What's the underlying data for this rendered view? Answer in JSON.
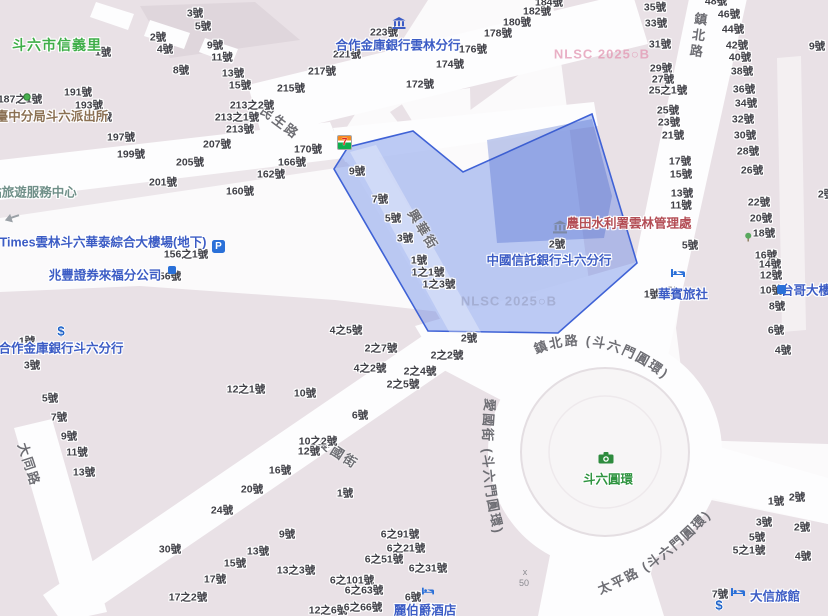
{
  "district_label": "斗六市信義里",
  "street_names": {
    "minsheng": "民生路",
    "xinghua": "興華街",
    "zhenbei": "鎮北路",
    "datong": "大同路",
    "aiguo": "愛國街",
    "zhenbei_circle": "鎮北路 (斗六門圓環)",
    "aiguo_circle": "愛國街 (斗六門圓環)",
    "taiping_circle": "太平路 (斗六門圓環)"
  },
  "colors": {
    "poi_blue": "#3c5cc5",
    "poi_green": "#2f9440",
    "poi_red": "#b34d55",
    "poi_brown": "#8a6f52",
    "poi_teal": "#6f8f88",
    "highlight_fill": "rgba(90,125,230,0.40)",
    "highlight_stroke": "#3f62d6",
    "block": "#e9e1e6",
    "street": "#fdfdfe"
  },
  "pois": [
    {
      "id": "hezuo-yunlin-branch",
      "label": "合作金庫銀行雲林分行",
      "x": 398,
      "y": 44,
      "color": "blue"
    },
    {
      "id": "police-station",
      "label": "臺中分局斗六派出所",
      "x": 52,
      "y": 115,
      "color": "brown"
    },
    {
      "id": "tourist-service-center",
      "label": "站旅遊服務中心",
      "x": 33,
      "y": 191,
      "color": "teal"
    },
    {
      "id": "times-parking",
      "label": "Times雲林斗六華泰綜合大樓場(地下)",
      "x": 103,
      "y": 241,
      "color": "blue"
    },
    {
      "id": "mega-securities",
      "label": "兆豐證券來福分公司",
      "x": 105,
      "y": 274,
      "color": "blue"
    },
    {
      "id": "hezuo-douliu-branch",
      "label": "合作金庫銀行斗六分行",
      "x": 61,
      "y": 347,
      "color": "blue"
    },
    {
      "id": "ctbc-douliu-branch",
      "label": "中國信託銀行斗六分行",
      "x": 549,
      "y": 259,
      "color": "blue"
    },
    {
      "id": "irrigation-agency",
      "label": "農田水利署雲林管理處",
      "x": 629,
      "y": 222,
      "color": "red"
    },
    {
      "id": "huabin-hostel",
      "label": "華賓旅社",
      "x": 683,
      "y": 293,
      "color": "blue"
    },
    {
      "id": "taiwan-mobile-building",
      "label": "台哥大樓",
      "x": 806,
      "y": 289,
      "color": "blue"
    },
    {
      "id": "daxin-hotel",
      "label": "大信旅館",
      "x": 775,
      "y": 595,
      "color": "blue"
    },
    {
      "id": "grand-earl-hotel",
      "label": "麗伯爵酒店",
      "x": 425,
      "y": 609,
      "color": "blue"
    },
    {
      "id": "douliu-circle",
      "label": "斗六圓環",
      "x": 608,
      "y": 478,
      "color": "green"
    },
    {
      "id": "xinyi-village",
      "label": "斗六市信義里",
      "x": 57,
      "y": 45,
      "color": "green",
      "cls": "district"
    }
  ],
  "icons": [
    {
      "name": "seven-eleven-icon",
      "x": 337,
      "y": 135
    },
    {
      "name": "bank-icon",
      "x": 399,
      "y": 23
    },
    {
      "name": "parking-icon",
      "x": 212,
      "y": 240
    },
    {
      "name": "securities-icon",
      "x": 168,
      "y": 266
    },
    {
      "name": "government-building-icon",
      "x": 560,
      "y": 227
    },
    {
      "name": "bed-icon",
      "x": 678,
      "y": 273
    },
    {
      "name": "bed-icon",
      "x": 738,
      "y": 592
    },
    {
      "name": "hotel-icon",
      "x": 428,
      "y": 591
    },
    {
      "name": "telecom-icon",
      "x": 777,
      "y": 285
    },
    {
      "name": "dollar-icon",
      "x": 61,
      "y": 331
    },
    {
      "name": "dollar-icon",
      "x": 719,
      "y": 605
    },
    {
      "name": "camera-icon",
      "x": 606,
      "y": 458
    },
    {
      "name": "pin-icon",
      "x": 27,
      "y": 97
    },
    {
      "name": "one-way-arrow-icon",
      "x": 12,
      "y": 218
    },
    {
      "name": "tree-icon",
      "x": 748,
      "y": 237
    }
  ],
  "watermarks": [
    {
      "text": "NLSC 2025○B",
      "x": 602,
      "y": 54,
      "tone": "pink"
    },
    {
      "text": "NLSC 2025○B",
      "x": 509,
      "y": 301,
      "tone": "gray"
    }
  ],
  "spot_height": [
    {
      "text": "x",
      "x": 525,
      "y": 572
    },
    {
      "text": "50",
      "x": 524,
      "y": 583
    }
  ],
  "house_numbers": [
    [
      "3號",
      195,
      13
    ],
    [
      "5號",
      203,
      26
    ],
    [
      "2號",
      158,
      37
    ],
    [
      "4號",
      165,
      49
    ],
    [
      "9號",
      215,
      45
    ],
    [
      "11號",
      222,
      57
    ],
    [
      "8號",
      181,
      70
    ],
    [
      "13號",
      233,
      73
    ],
    [
      "15號",
      240,
      85
    ],
    [
      "1號",
      103,
      52
    ],
    [
      "187之1號",
      20,
      99
    ],
    [
      "191號",
      78,
      92
    ],
    [
      "193號",
      89,
      105
    ],
    [
      "195號",
      98,
      117
    ],
    [
      "197號",
      121,
      137
    ],
    [
      "199號",
      131,
      154
    ],
    [
      "201號",
      163,
      182
    ],
    [
      "205號",
      190,
      162
    ],
    [
      "207號",
      217,
      144
    ],
    [
      "213號",
      240,
      129
    ],
    [
      "213之1號",
      237,
      117
    ],
    [
      "213之2號",
      252,
      105
    ],
    [
      "215號",
      291,
      88
    ],
    [
      "217號",
      322,
      71
    ],
    [
      "221號",
      347,
      54
    ],
    [
      "223號",
      384,
      32
    ],
    [
      "170號",
      308,
      149
    ],
    [
      "166號",
      292,
      162
    ],
    [
      "162號",
      271,
      174
    ],
    [
      "160號",
      240,
      191
    ],
    [
      "156之1號",
      186,
      254
    ],
    [
      "56號",
      170,
      276
    ],
    [
      "172號",
      420,
      84
    ],
    [
      "174號",
      450,
      64
    ],
    [
      "176號",
      473,
      49
    ],
    [
      "178號",
      498,
      33
    ],
    [
      "180號",
      517,
      22
    ],
    [
      "182號",
      537,
      11
    ],
    [
      "184號",
      549,
      2
    ],
    [
      "35號",
      655,
      7
    ],
    [
      "33號",
      656,
      23
    ],
    [
      "31號",
      660,
      44
    ],
    [
      "29號",
      661,
      68
    ],
    [
      "27號",
      663,
      79
    ],
    [
      "25之1號",
      668,
      90
    ],
    [
      "25號",
      668,
      110
    ],
    [
      "23號",
      669,
      122
    ],
    [
      "21號",
      673,
      135
    ],
    [
      "17號",
      680,
      161
    ],
    [
      "15號",
      681,
      174
    ],
    [
      "13號",
      682,
      193
    ],
    [
      "11號",
      681,
      205
    ],
    [
      "9號",
      682,
      224
    ],
    [
      "5號",
      690,
      245
    ],
    [
      "1號",
      652,
      294
    ],
    [
      "3號",
      670,
      292
    ],
    [
      "48號",
      716,
      1
    ],
    [
      "46號",
      729,
      14
    ],
    [
      "44號",
      733,
      29
    ],
    [
      "42號",
      737,
      45
    ],
    [
      "40號",
      740,
      57
    ],
    [
      "38號",
      742,
      71
    ],
    [
      "36號",
      744,
      89
    ],
    [
      "34號",
      746,
      103
    ],
    [
      "32號",
      743,
      119
    ],
    [
      "30號",
      745,
      135
    ],
    [
      "28號",
      748,
      151
    ],
    [
      "26號",
      752,
      170
    ],
    [
      "22號",
      759,
      202
    ],
    [
      "20號",
      761,
      218
    ],
    [
      "18號",
      764,
      233
    ],
    [
      "16號",
      766,
      255
    ],
    [
      "14號",
      770,
      264
    ],
    [
      "12號",
      771,
      275
    ],
    [
      "10號",
      771,
      290
    ],
    [
      "8號",
      777,
      306
    ],
    [
      "6號",
      776,
      330
    ],
    [
      "4號",
      783,
      350
    ],
    [
      "2號",
      826,
      194
    ],
    [
      "9號",
      817,
      46
    ],
    [
      "9號",
      357,
      171
    ],
    [
      "7號",
      380,
      199
    ],
    [
      "5號",
      393,
      218
    ],
    [
      "3號",
      405,
      238
    ],
    [
      "1號",
      419,
      260
    ],
    [
      "1之1號",
      428,
      272
    ],
    [
      "1之3號",
      439,
      284
    ],
    [
      "2號",
      557,
      244
    ],
    [
      "12之1號",
      246,
      389
    ],
    [
      "4之5號",
      346,
      330
    ],
    [
      "2之7號",
      381,
      348
    ],
    [
      "4之2號",
      370,
      368
    ],
    [
      "2之4號",
      420,
      371
    ],
    [
      "2之5號",
      403,
      384
    ],
    [
      "2之2號",
      447,
      355
    ],
    [
      "2號",
      469,
      338
    ],
    [
      "10號",
      305,
      393
    ],
    [
      "6號",
      360,
      415
    ],
    [
      "10之2號",
      318,
      441
    ],
    [
      "12號",
      309,
      451
    ],
    [
      "16號",
      280,
      470
    ],
    [
      "1號",
      27,
      341
    ],
    [
      "3號",
      32,
      365
    ],
    [
      "5號",
      50,
      398
    ],
    [
      "7號",
      59,
      417
    ],
    [
      "9號",
      69,
      436
    ],
    [
      "11號",
      77,
      452
    ],
    [
      "13號",
      84,
      472
    ],
    [
      "20號",
      252,
      489
    ],
    [
      "24號",
      222,
      510
    ],
    [
      "30號",
      170,
      549
    ],
    [
      "1號",
      345,
      493
    ],
    [
      "9號",
      287,
      534
    ],
    [
      "13號",
      258,
      551
    ],
    [
      "15號",
      235,
      563
    ],
    [
      "13之3號",
      296,
      570
    ],
    [
      "17號",
      215,
      579
    ],
    [
      "17之2號",
      188,
      597
    ],
    [
      "12之6號",
      328,
      610
    ],
    [
      "6之91號",
      400,
      534
    ],
    [
      "6之21號",
      406,
      548
    ],
    [
      "6之51號",
      384,
      559
    ],
    [
      "6之31號",
      428,
      568
    ],
    [
      "6之101號",
      352,
      580
    ],
    [
      "6之63號",
      364,
      590
    ],
    [
      "6號",
      413,
      597
    ],
    [
      "6之66號",
      363,
      607
    ],
    [
      "1號",
      776,
      501
    ],
    [
      "2號",
      797,
      497
    ],
    [
      "3號",
      764,
      522
    ],
    [
      "2號",
      802,
      527
    ],
    [
      "5號",
      757,
      537
    ],
    [
      "5之1號",
      749,
      550
    ],
    [
      "4號",
      803,
      556
    ],
    [
      "7號",
      720,
      594
    ]
  ]
}
